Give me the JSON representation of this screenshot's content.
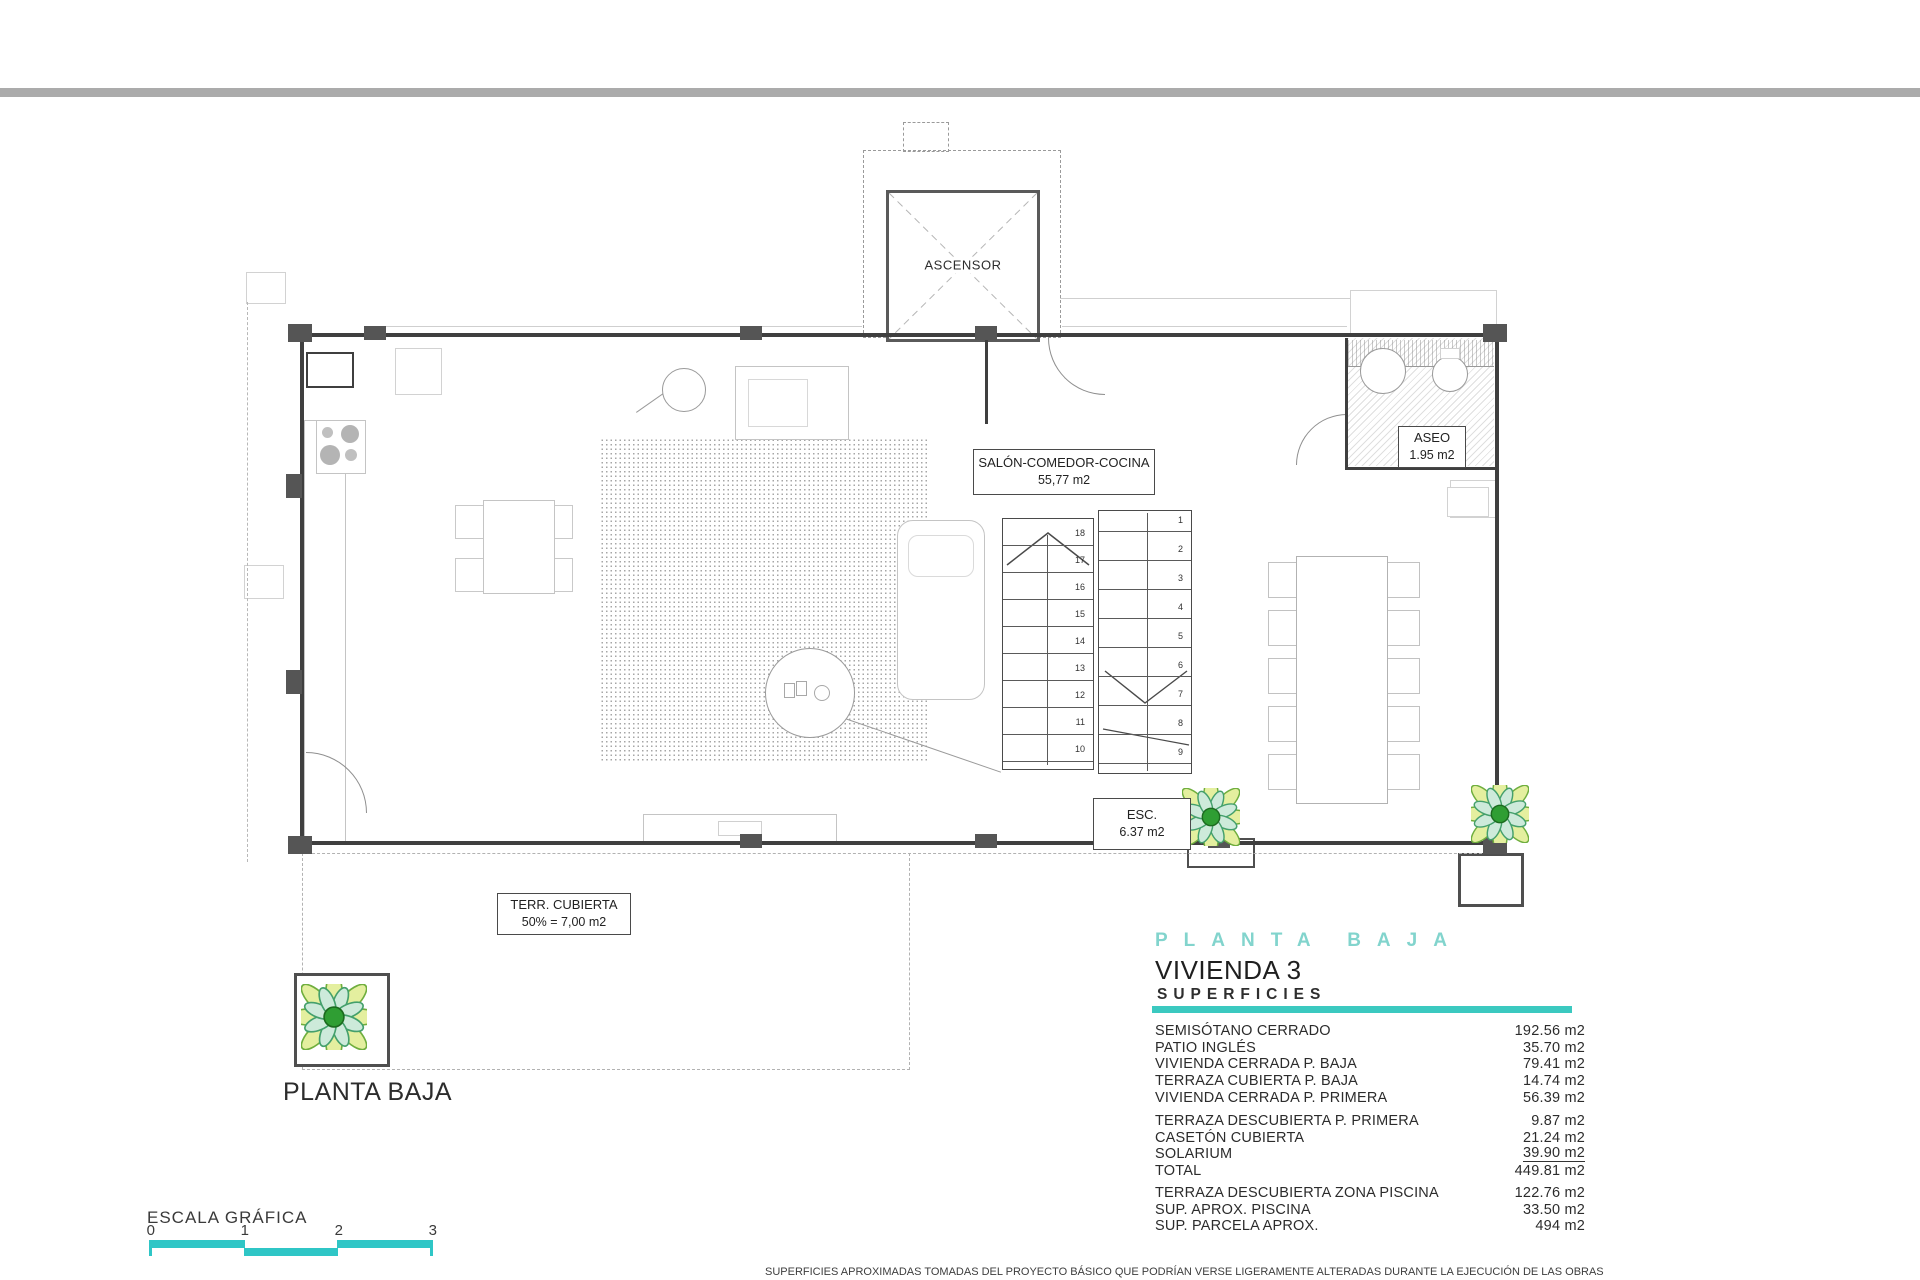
{
  "colors": {
    "accent": "#3bc9c0",
    "bar": "#2fc6c6",
    "spaced": "#82d4cd"
  },
  "plan": {
    "elevator_label": "ASCENSOR",
    "salon": {
      "line1": "SALÓN-COMEDOR-COCINA",
      "line2": "55,77 m2"
    },
    "aseo": {
      "line1": "ASEO",
      "line2": "1.95 m2"
    },
    "esc": {
      "line1": "ESC.",
      "line2": "6.37 m2"
    },
    "terr": {
      "line1": "TERR. CUBIERTA",
      "line2": "50% = 7,00 m2"
    },
    "floor_title": "PLANTA BAJA",
    "stairs": {
      "left_numbers": [
        "18",
        "17",
        "16",
        "15",
        "14",
        "13",
        "12",
        "11",
        "10"
      ],
      "right_numbers": [
        "1",
        "2",
        "3",
        "4",
        "5",
        "6",
        "7",
        "8",
        "9"
      ]
    }
  },
  "panel": {
    "floor_spaced": "PLANTA BAJA",
    "dwelling": "VIVIENDA 3",
    "heading": "SUPERFICIES"
  },
  "surfaces": {
    "rows": [
      {
        "label": "SEMISÓTANO CERRADO",
        "value": "192.56 m2"
      },
      {
        "label": "PATIO INGLÉS",
        "value": "35.70 m2"
      },
      {
        "label": "VIVIENDA CERRADA P. BAJA",
        "value": "79.41 m2"
      },
      {
        "label": "TERRAZA CUBIERTA P. BAJA",
        "value": "14.74 m2"
      },
      {
        "label": "VIVIENDA CERRADA P. PRIMERA",
        "value": "56.39 m2"
      },
      {
        "label": "TERRAZA DESCUBIERTA P. PRIMERA",
        "value": "9.87 m2",
        "gap": true
      },
      {
        "label": "CASETÓN CUBIERTA",
        "value": "21.24 m2"
      },
      {
        "label": "SOLARIUM",
        "value": "39.90 m2",
        "underline": true
      },
      {
        "label": "TOTAL",
        "value": "449.81 m2"
      }
    ],
    "extra_rows": [
      {
        "label": "TERRAZA DESCUBIERTA  ZONA PISCINA",
        "value": "122.76 m2"
      },
      {
        "label": "SUP.  APROX.  PISCINA",
        "value": "33.50 m2"
      },
      {
        "label": "SUP. PARCELA APROX.",
        "value": "494 m2"
      }
    ]
  },
  "scale": {
    "label": "ESCALA GRÁFICA",
    "ticks": [
      "0",
      "1",
      "2",
      "3"
    ]
  },
  "footer": {
    "disclaimer": "SUPERFICIES APROXIMADAS TOMADAS DEL PROYECTO BÁSICO QUE PODRÍAN VERSE LIGERAMENTE ALTERADAS DURANTE LA EJECUCIÓN DE LAS OBRAS"
  }
}
